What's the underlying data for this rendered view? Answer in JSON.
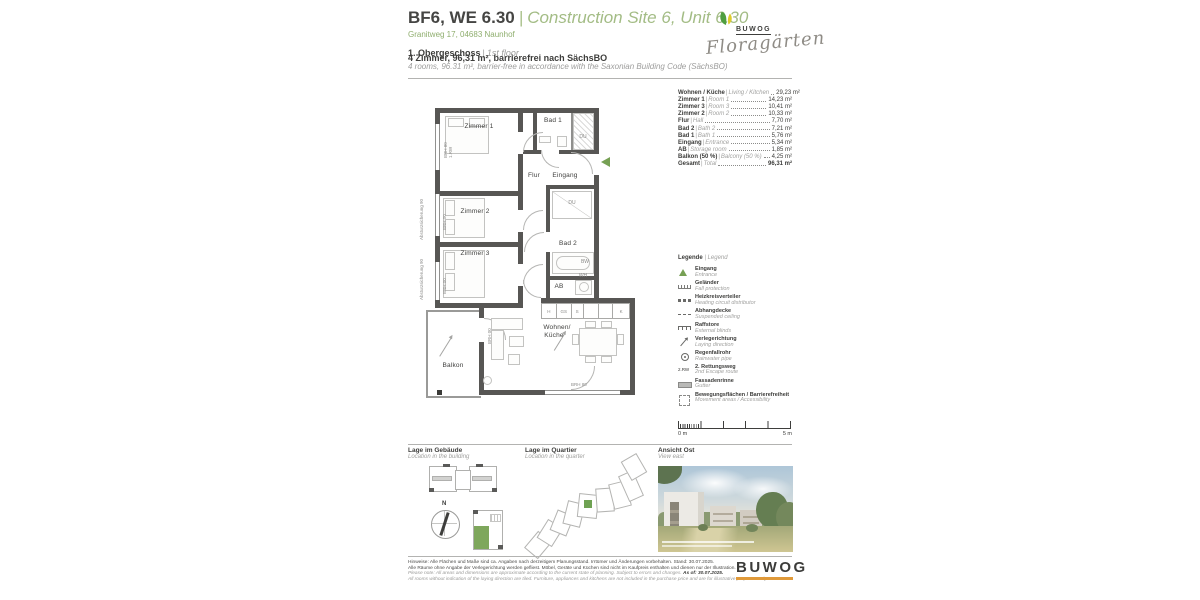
{
  "ui": {
    "pipe": "|"
  },
  "header": {
    "title_main": "BF6, WE 6.30",
    "title_sub": "Construction Site 6, Unit 6.30",
    "address": "Granitweg 17, 04683 Naunhof",
    "floor_de": "1. Obergeschoss",
    "floor_en": "1st floor",
    "summary_de": "4 Zimmer, 96,31 m², barrierefrei nach SächsBO",
    "summary_en": "4 rooms, 96.31 m², barrier-free in accordance with the Saxonian Building Code (SächsBO)",
    "logo_brand": "BUWOG",
    "logo_project": "Floragärten"
  },
  "plan": {
    "rooms": {
      "zimmer1": "Zimmer 1",
      "zimmer2": "Zimmer 2",
      "zimmer3": "Zimmer 3",
      "bad1": "Bad 1",
      "bad2": "Bad 2",
      "flur": "Flur",
      "eingang": "Eingang",
      "ab": "AB",
      "wohnen": "Wohnen/",
      "kueche": "Küche",
      "balkon": "Balkon"
    },
    "fixtures": {
      "du": "DU",
      "bw": "BW",
      "wh": "WH"
    },
    "kitchen": [
      "H",
      "GS",
      "S",
      "",
      "",
      "K"
    ],
    "annotations": {
      "absturz": "Absturzsicherung 90",
      "brh80": "BRH 80",
      "rw1": "1.RW",
      "brh00": "BRH 00"
    }
  },
  "areas": {
    "items": [
      {
        "de": "Wohnen / Küche",
        "en": "Living / Kitchen",
        "value": "29,23 m²"
      },
      {
        "de": "Zimmer 1",
        "en": "Room 1",
        "value": "14,23 m²"
      },
      {
        "de": "Zimmer 3",
        "en": "Room 3",
        "value": "10,41 m²"
      },
      {
        "de": "Zimmer 2",
        "en": "Room 2",
        "value": "10,33 m²"
      },
      {
        "de": "Flur",
        "en": "Hall",
        "value": "7,70 m²"
      },
      {
        "de": "Bad 2",
        "en": "Bath 2",
        "value": "7,21 m²"
      },
      {
        "de": "Bad 1",
        "en": "Bath 1",
        "value": "5,76 m²"
      },
      {
        "de": "Eingang",
        "en": "Entrance",
        "value": "5,34 m²"
      },
      {
        "de": "AB",
        "en": "Storage room",
        "value": "1,85 m²"
      },
      {
        "de": "Balkon (50 %)",
        "en": "Balcony (50 %)",
        "value": "4,25 m²"
      },
      {
        "de": "Gesamt",
        "en": "Total",
        "value": "96,31 m²"
      }
    ]
  },
  "legend": {
    "title_de": "Legende",
    "title_en": "Legend",
    "items": [
      {
        "de": "Eingang",
        "en": "Entrance"
      },
      {
        "de": "Geländer",
        "en": "Fall protection"
      },
      {
        "de": "Heizkreisverteiler",
        "en": "Heating circuit distributor"
      },
      {
        "de": "Abhangdecke",
        "en": "Suspended ceiling"
      },
      {
        "de": "Raffstore",
        "en": "External blinds"
      },
      {
        "de": "Verlegerichtung",
        "en": "Laying direction"
      },
      {
        "de": "Regenfallrohr",
        "en": "Rainwater pipe"
      },
      {
        "de": "2. Rettungsweg",
        "en": "2nd Escape route",
        "icon_label": "2.RW"
      },
      {
        "de": "Fassadenrinne",
        "en": "Gutter"
      },
      {
        "de": "Bewegungsflächen / Barrierefreiheit",
        "en": "Movement areas / Accessibility"
      }
    ]
  },
  "scale": {
    "zero": "0 m",
    "five": "5 m"
  },
  "sections": {
    "building_de": "Lage im Gebäude",
    "building_en": "Location in the building",
    "quarter_de": "Lage im Quartier",
    "quarter_en": "Location in the quarter",
    "view_de": "Ansicht Ost",
    "view_en": "View east",
    "compass_n": "N"
  },
  "footer": {
    "de1": "Hinweise: Alle Flächen und Maße sind ca. Angaben nach derzeitigem Planungsstand. Irrtümer und Änderungen vorbehalten. Stand: 30.07.2025.",
    "de2": "Alle Räume ohne Angabe der Verlegerichtung werden gefliest. Möbel, Geräte und Küchen sind nicht im Kaufpreis enthalten und dienen nur der Illustration.",
    "en1": "Please note: All areas and dimensions are approximate according to the current state of planning. Subject to errors and changes.",
    "en1b": "As of: 30.07.2025.",
    "en2": "All rooms without indication of the laying direction are tiled. Furniture, appliances and kitchens are not included in the purchase price and are for illustrative purposes only.",
    "brand": "BUWOG"
  }
}
